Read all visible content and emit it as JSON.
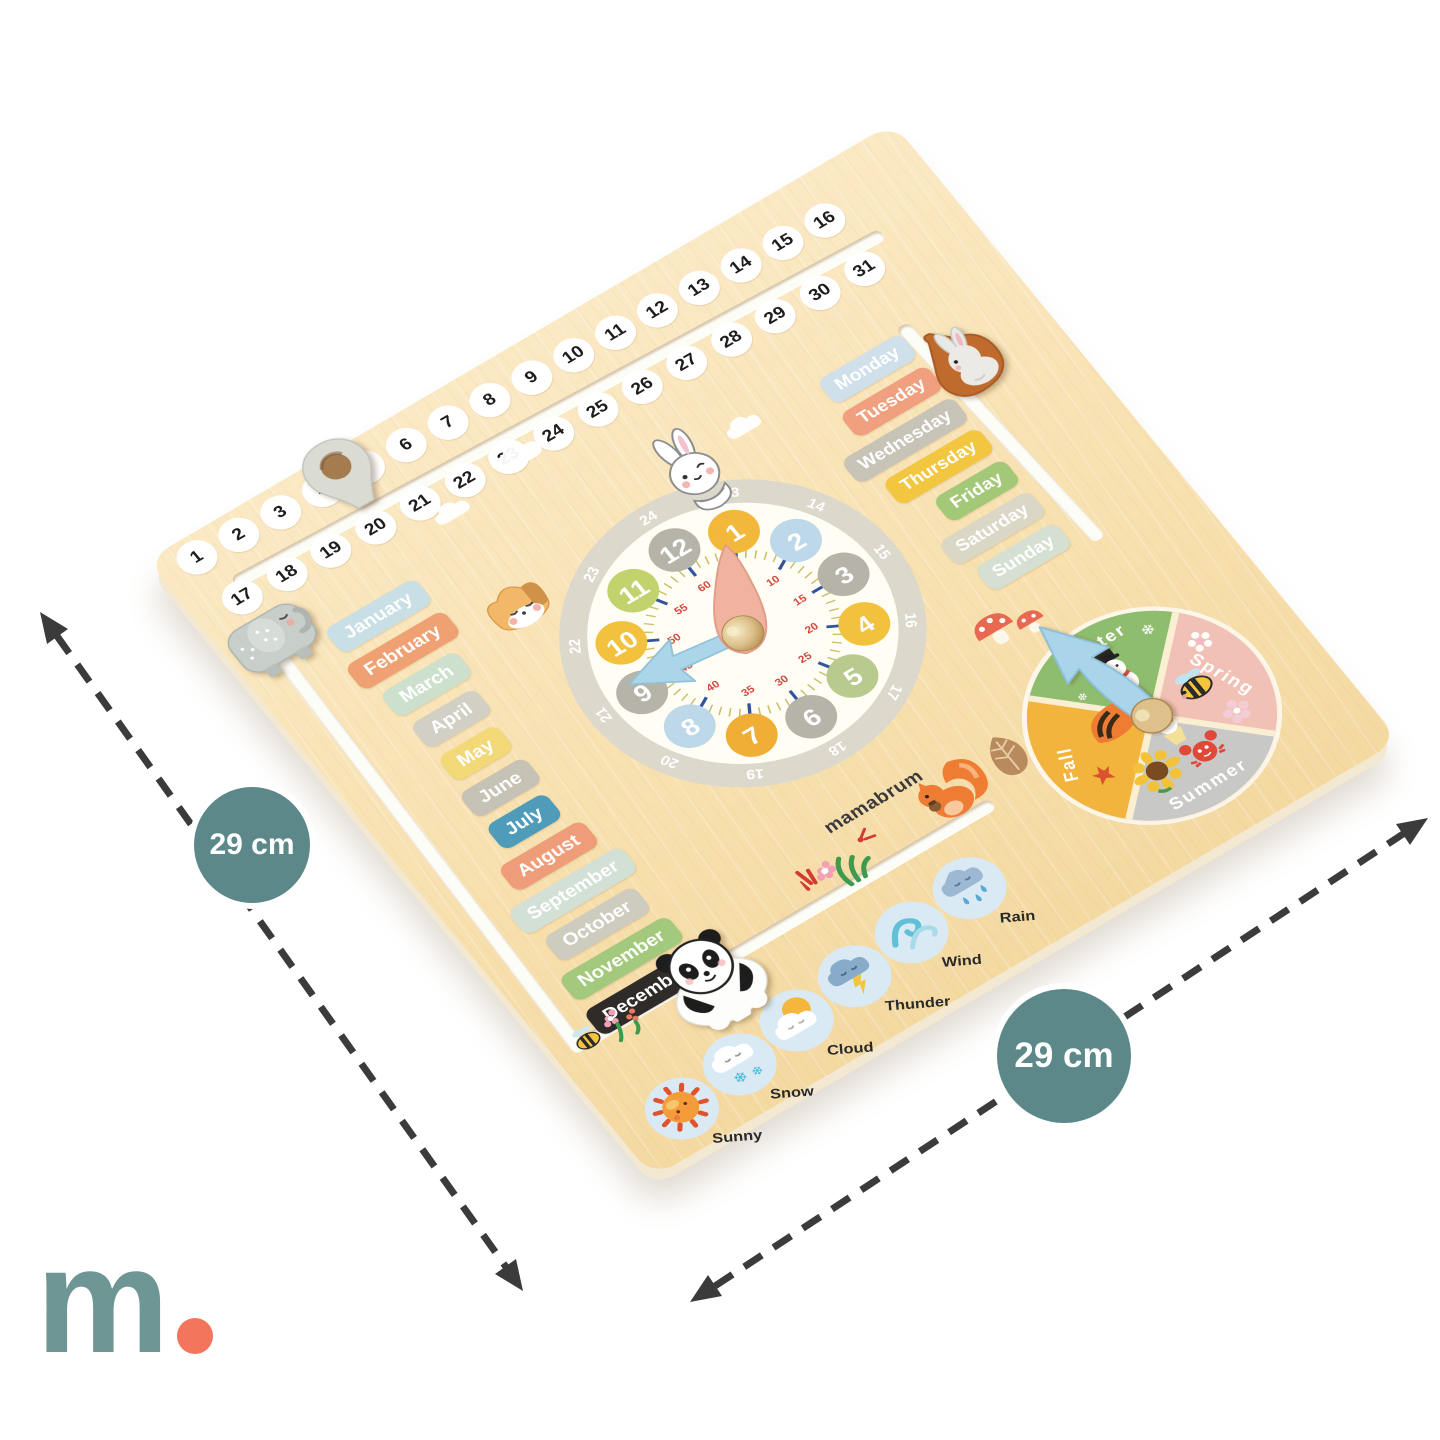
{
  "brand": "mamabrum",
  "annotations": {
    "left_badge": "29 cm",
    "right_badge": "29 cm"
  },
  "logo": {
    "letter": "m"
  },
  "colors": {
    "badge": "#5d8889",
    "logo_m": "#6e9694",
    "logo_dot": "#f3755b",
    "wood": "#f8e1b0",
    "arrow_dash": "#3b3b3b"
  },
  "board": {
    "dates_row1": [
      "1",
      "2",
      "3",
      "4",
      "5",
      "6",
      "7",
      "8",
      "9",
      "10",
      "11",
      "12",
      "13",
      "14",
      "15",
      "16"
    ],
    "dates_row2": [
      "17",
      "18",
      "19",
      "20",
      "21",
      "22",
      "23",
      "24",
      "25",
      "26",
      "27",
      "28",
      "29",
      "30",
      "31"
    ],
    "months": [
      {
        "label": "January",
        "color": "#c9dfe6"
      },
      {
        "label": "February",
        "color": "#f0a173"
      },
      {
        "label": "March",
        "color": "#cde0cd"
      },
      {
        "label": "April",
        "color": "#d2cfc4"
      },
      {
        "label": "May",
        "color": "#f3d878"
      },
      {
        "label": "June",
        "color": "#c6c2b6"
      },
      {
        "label": "July",
        "color": "#4f9cba"
      },
      {
        "label": "August",
        "color": "#ef9d78"
      },
      {
        "label": "September",
        "color": "#d3e0d6"
      },
      {
        "label": "October",
        "color": "#cecbbf"
      },
      {
        "label": "November",
        "color": "#a3ca7c"
      },
      {
        "label": "December",
        "color": "#2e2b29"
      }
    ],
    "days": [
      {
        "label": "Monday",
        "color": "#cfe0ea"
      },
      {
        "label": "Tuesday",
        "color": "#f0a07e"
      },
      {
        "label": "Wednesday",
        "color": "#c8c3b7"
      },
      {
        "label": "Thursday",
        "color": "#f2c63e"
      },
      {
        "label": "Friday",
        "color": "#a2c878"
      },
      {
        "label": "Saturday",
        "color": "#dbd7c7"
      },
      {
        "label": "Sunday",
        "color": "#d6e0d2"
      }
    ],
    "clock": {
      "hours": [
        {
          "label": "1",
          "color": "#f2b83b"
        },
        {
          "label": "2",
          "color": "#bdd8e8"
        },
        {
          "label": "3",
          "color": "#b6b3a9"
        },
        {
          "label": "4",
          "color": "#f2c13d"
        },
        {
          "label": "5",
          "color": "#b9ca8e"
        },
        {
          "label": "6",
          "color": "#b6b3a9"
        },
        {
          "label": "7",
          "color": "#f0ae36"
        },
        {
          "label": "8",
          "color": "#bdd8e8"
        },
        {
          "label": "9",
          "color": "#b6b3a9"
        },
        {
          "label": "10",
          "color": "#f2c13d"
        },
        {
          "label": "11",
          "color": "#c2d36d"
        },
        {
          "label": "12",
          "color": "#b6b3a9"
        }
      ],
      "ring": [
        "13",
        "14",
        "15",
        "16",
        "17",
        "18",
        "19",
        "20",
        "21",
        "22",
        "23",
        "24"
      ],
      "minutes": [
        "5",
        "10",
        "15",
        "20",
        "25",
        "30",
        "35",
        "40",
        "45",
        "50",
        "55",
        "60"
      ],
      "hand_colors": {
        "hour": "#f1b3a0",
        "minute": "#abd5e9"
      }
    },
    "seasons": [
      {
        "label": "Winter",
        "color": "#8fbd6e"
      },
      {
        "label": "Spring",
        "color": "#f1c1b5"
      },
      {
        "label": "Summer",
        "color": "#c8c8c6"
      },
      {
        "label": "Fall",
        "color": "#f3b43d"
      }
    ],
    "weather": [
      {
        "label": "Sunny",
        "icon": "sun-icon"
      },
      {
        "label": "Snow",
        "icon": "snow-cloud-icon"
      },
      {
        "label": "Cloud",
        "icon": "sun-cloud-icon"
      },
      {
        "label": "Thunder",
        "icon": "thunder-cloud-icon"
      },
      {
        "label": "Wind",
        "icon": "wind-icon"
      },
      {
        "label": "Rain",
        "icon": "rain-cloud-icon"
      }
    ]
  }
}
